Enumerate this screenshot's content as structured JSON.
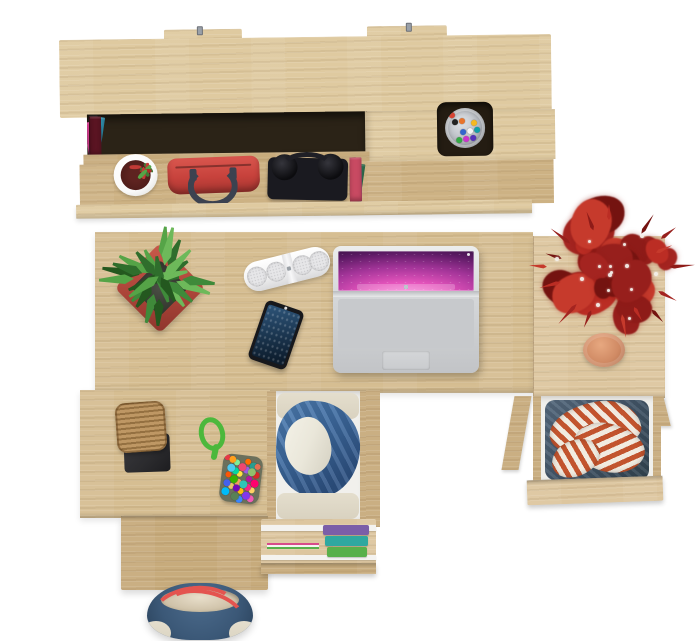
{
  "meta": {
    "description": "Top-down product photo of a Sonoma oak home-office set: wall shelf with books and accessories, desk with laptop, phone, speaker and plants, plus open clothing drawers and bags",
    "canvas": {
      "width": 700,
      "height": 641
    },
    "background": "#ffffff"
  },
  "colors": {
    "bg": "#ffffff",
    "oak": "#d8c296",
    "oak_light": "#dfcaa0",
    "oak_desk": "#d6be92",
    "oak_side": "#ddc69f",
    "oak_dark": "#c7ab7c",
    "oak_floor": "#cdb284",
    "recess": "#2b2317",
    "hole": "#241c12",
    "metal": "#9aa0a8",
    "leather_gold": "#c79a3d",
    "cup_metal": "#b9bdc4",
    "cup_white": "#fafafa",
    "soil": "#5e2320",
    "bag_red": "#c7423c",
    "strap_dark": "#3c4250",
    "headphone": "#0c0c0f",
    "pot_red": "#b2483c",
    "pot_red_dark": "#8e352c",
    "terracotta": "#d08a64",
    "terracotta_dark": "#b06d4a",
    "speaker": "#f2f2f2",
    "speaker_grille": "#c9c9cc",
    "phone_body": "#17181c",
    "phone_screen": "#1d3954",
    "laptop_body": "#d5d7d9",
    "laptop_key": "#1b1b1e",
    "laptop_tp": "#c9cbce",
    "drawer_liner": "#f1f0ec",
    "denim": "#45586b",
    "denim_dark": "#32434f",
    "stripe_red": "#c2542e",
    "stripe_white": "#f1ebe0",
    "jacket_blue": "#3e6ba0",
    "jacket_blue_dark": "#2e5283",
    "shirt_white": "#eae7da",
    "cloth_cream": "#d9d2c0",
    "clothes_purple": "#7b5ea8",
    "clothes_teal": "#2fa8a0",
    "clothes_green": "#58b04a",
    "clothes_pink": "#d84a8a",
    "tray_dark": "#2b2b2e",
    "box_wood": "#b5894f",
    "rope_green": "#4cb83c",
    "pouch_base": "#6b705c",
    "tote_navy": "#3b5877",
    "tote_trim": "#cdc0a6",
    "tote_strap": "#e4544f",
    "bloom": "#c23a36",
    "leaf_green": "#3f7a35"
  },
  "shelf": {
    "books_upper": [
      "#23365c",
      "#e9e4d6",
      "#2e8ba8",
      "#1f5fa6",
      "#efe8d6",
      "#e8c93e",
      "#9fb93a",
      "#23232a",
      "#efe9dc",
      "#3a7d44",
      "#1d1d22",
      "#d8d2c2",
      "#c8356e",
      "#d23b8f",
      "#7a2ea0",
      "#ece6d8",
      "#3593a8",
      "#1b6b75",
      "#27272b",
      "#17171a",
      "#6a3fa0",
      "#2a57a8",
      "#15151a",
      "#8a66c8"
    ],
    "books_leather": {
      "colors": [
        "#5a1422",
        "#4c101e",
        "#611726",
        "#541322",
        "#5a1422"
      ],
      "gold": "#c79a3d"
    },
    "books_lower": [
      "#7a1f2e",
      "#e8e2d4",
      "#2f6e4f",
      "#35809a",
      "#17171c",
      "#5b3a24",
      "#d8d2c4",
      "#7fae3f",
      "#27405f",
      "#e3ddcf",
      "#274f8f",
      "#8a6a2f",
      "#1c1c20",
      "#c03a52",
      "#2a7a8c",
      "#e0b83a",
      "#23232a",
      "#c84a62"
    ],
    "pencil_cup_pens": [
      "#d64333",
      "#3366cc",
      "#f5b821",
      "#33aa44",
      "#f4f4f4",
      "#222222",
      "#cc33cc",
      "#11a0a8",
      "#e8742c",
      "#5533bb"
    ],
    "flower_sprigs": [
      "#c23a36",
      "#3f7a35",
      "#c23a36",
      "#55a447",
      "#a82e2a",
      "#3f7a35",
      "#c23a36",
      "#55a447"
    ]
  },
  "plants": {
    "green_leaf_colors": [
      "#2f6e2c",
      "#3f8a3a",
      "#55a447",
      "#6db95a",
      "#24581f"
    ],
    "red_leaf_colors": [
      "#8e1b18",
      "#a42420",
      "#bb2d24",
      "#741310",
      "#c63a2c",
      "#971f1c"
    ]
  },
  "laptop": {
    "key_rows": [
      13,
      12,
      12,
      12,
      12
    ],
    "bottom_row": [
      1.4,
      1,
      1,
      5,
      1,
      1,
      1.4
    ],
    "dock_icons": [
      "#6ab4f0",
      "#f5c242",
      "#e8544a",
      "#57c05a",
      "#b07cf0",
      "#f08c2e",
      "#4dd0c0",
      "#e84f8c",
      "#8a9cf0",
      "#f0e04a",
      "#50b0e8",
      "#c0c4cc"
    ]
  },
  "accessories": {
    "pom_colors": [
      "#e63946",
      "#f4a261",
      "#2a9d8f",
      "#e9c46a",
      "#9b5de5",
      "#00bbf9",
      "#fee440",
      "#f15bb5",
      "#38b000",
      "#ff6d00",
      "#4361ee",
      "#ef476f",
      "#ffd166",
      "#06d6a0",
      "#8338ec",
      "#fb5607",
      "#3a86ff",
      "#ff006e",
      "#80ed99",
      "#f72585",
      "#4cc9f0",
      "#ffbe0b",
      "#d62828",
      "#588157",
      "#b5179e",
      "#ff9f1c",
      "#2ec4b6",
      "#e76f51",
      "#7209b7",
      "#90be6d"
    ],
    "folded_clothes": [
      "#7b5ea8",
      "#2fa8a0",
      "#58b04a"
    ],
    "folded_strip": [
      "#d84a8a",
      "#f4f3f0",
      "#58b04a"
    ]
  }
}
